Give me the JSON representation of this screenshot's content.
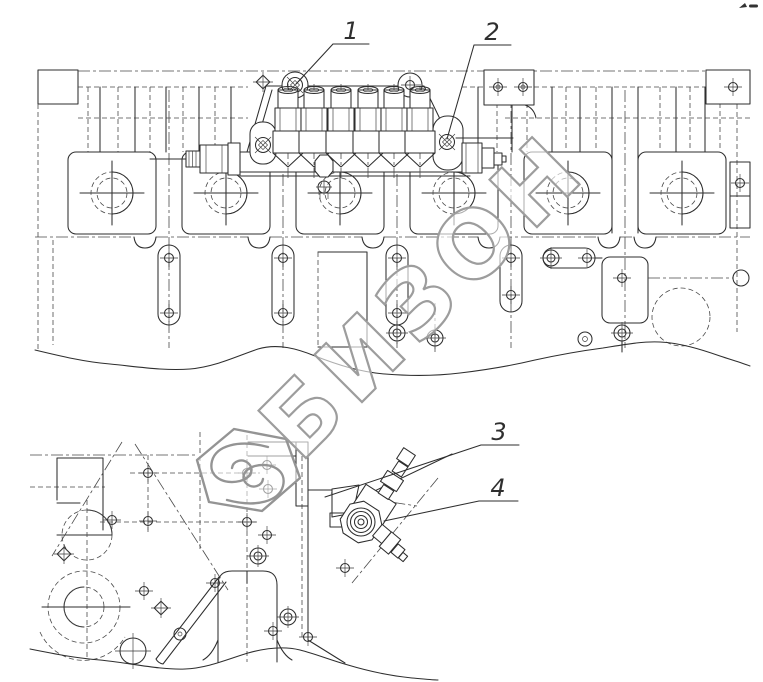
{
  "figure": {
    "kind": "technical parts drawing",
    "views": [
      {
        "name": "cylinder block top view with fuel injection pump"
      },
      {
        "name": "cylinder block side view with fuel transfer pump"
      }
    ]
  },
  "callouts": [
    {
      "label": "1"
    },
    {
      "label": "2"
    },
    {
      "label": "3"
    },
    {
      "label": "4"
    }
  ],
  "watermark": {
    "text": "БИЗОН"
  },
  "colors": {
    "background": "#ffffff",
    "line": "#2e2e2e",
    "hidden_line": "#4a4a4a",
    "watermark": "#9d9d9d"
  }
}
